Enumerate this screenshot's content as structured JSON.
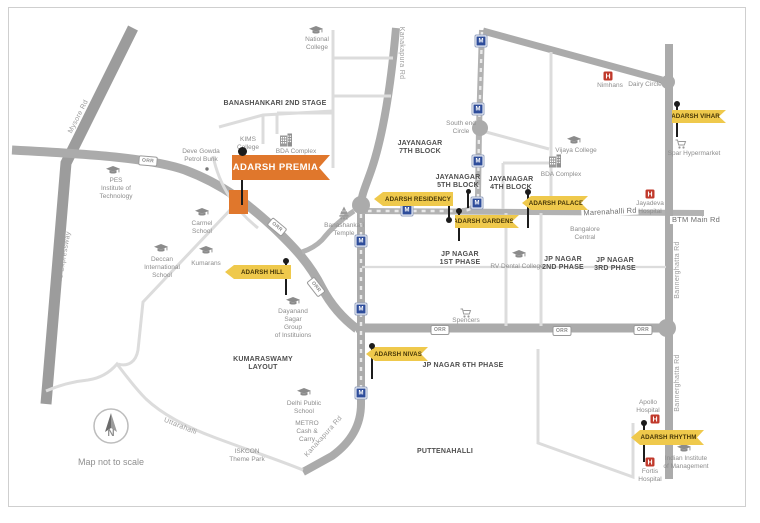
{
  "map": {
    "scale_note": "Map not to scale",
    "compass_label": "N",
    "metro_label": "M",
    "orr_label": "ORR",
    "colors": {
      "accent_orange": "#e0772c",
      "flag_yellow": "#efc94c",
      "flag_text": "#463607",
      "hospital_red": "#c0392b",
      "metro_blue": "#2e4d9b",
      "road_major": "#ababab",
      "road_minor": "#dcdcdc"
    },
    "premia": {
      "label": "ADARSH PREMIA",
      "x": 232,
      "y": 155,
      "w": 98,
      "h": 25,
      "site": {
        "x": 229,
        "y": 190,
        "w": 19,
        "h": 24
      },
      "pin": {
        "x": 242,
        "y1": 151,
        "y2": 205
      }
    },
    "property_flags": [
      {
        "id": "residency",
        "label": "ADARSH RESIDENCY",
        "x": 374,
        "y": 192,
        "w": 79,
        "h": 14,
        "shape": "arrow-straight",
        "pin": {
          "x": 449,
          "y1": 194,
          "y2": 220,
          "ball": "bottom"
        }
      },
      {
        "id": "gardens",
        "label": "ADARSH GARDENS",
        "x": 455,
        "y": 215,
        "w": 64,
        "h": 13,
        "shape": "flat-swallow",
        "pin": {
          "x": 459,
          "y1": 211,
          "y2": 241,
          "ball": "top"
        }
      },
      {
        "id": "palace",
        "label": "ADARSH PALACE",
        "x": 522,
        "y": 196,
        "w": 66,
        "h": 14,
        "shape": "arrow-swallow",
        "pin": {
          "x": 528,
          "y1": 192,
          "y2": 228,
          "ball": "top"
        }
      },
      {
        "id": "vihar",
        "label": "ADARSH VIHAR",
        "x": 672,
        "y": 110,
        "w": 54,
        "h": 13,
        "shape": "flat-swallow",
        "pin": {
          "x": 677,
          "y1": 104,
          "y2": 137,
          "ball": "top"
        }
      },
      {
        "id": "hill",
        "label": "ADARSH HILL",
        "x": 225,
        "y": 265,
        "w": 66,
        "h": 14,
        "shape": "arrow-straight",
        "pin": {
          "x": 286,
          "y1": 261,
          "y2": 295,
          "ball": "top"
        }
      },
      {
        "id": "nivas",
        "label": "ADARSH NIVAS",
        "x": 366,
        "y": 347,
        "w": 62,
        "h": 14,
        "shape": "arrow-swallow",
        "pin": {
          "x": 372,
          "y1": 346,
          "y2": 379,
          "ball": "top"
        }
      },
      {
        "id": "rhythm",
        "label": "ADARSH RHYTHM",
        "x": 631,
        "y": 430,
        "w": 73,
        "h": 15,
        "shape": "arrow-swallow",
        "pin": {
          "x": 644,
          "y1": 423,
          "y2": 462,
          "ball": "top"
        }
      }
    ],
    "extra_pins": [
      {
        "name": "jayanagar-5th-block-pin",
        "x": 468,
        "y1": 191,
        "y2": 208,
        "ball": "top"
      }
    ],
    "area_labels": [
      {
        "text": "BANASHANKARI 2ND STAGE",
        "x": 275,
        "y": 104
      },
      {
        "text": "JAYANAGAR\n7TH BLOCK",
        "x": 420,
        "y": 148
      },
      {
        "text": "JAYANAGAR\n5TH BLOCK",
        "x": 458,
        "y": 182
      },
      {
        "text": "JAYANAGAR\n4TH BLOCK",
        "x": 511,
        "y": 184
      },
      {
        "text": "JP NAGAR\n1ST PHASE",
        "x": 460,
        "y": 259
      },
      {
        "text": "JP NAGAR\n2ND PHASE",
        "x": 563,
        "y": 264
      },
      {
        "text": "JP NAGAR\n3RD PHASE",
        "x": 615,
        "y": 265
      },
      {
        "text": "JP NAGAR 6TH PHASE",
        "x": 463,
        "y": 366
      },
      {
        "text": "KUMARASWAMY\nLAYOUT",
        "x": 263,
        "y": 364
      },
      {
        "text": "PUTTENAHALLI",
        "x": 445,
        "y": 452
      }
    ],
    "poi_labels": [
      {
        "name": "national-college",
        "icon": "grad-cap",
        "ix": 316,
        "iy": 31,
        "text": "National\nCollege",
        "x": 317,
        "y": 44
      },
      {
        "name": "kims-college",
        "icon": null,
        "text": "KIMS\nCollege",
        "x": 248,
        "y": 144
      },
      {
        "name": "bda-complex-west",
        "icon": "building",
        "ix": 286,
        "iy": 140,
        "text": "BDA Complex",
        "x": 296,
        "y": 152
      },
      {
        "name": "deve-gowda-petrol-bunk",
        "icon": "dot",
        "ix": 207,
        "iy": 169,
        "text": "Deve Gowda\nPetrol Bunk",
        "x": 201,
        "y": 156
      },
      {
        "name": "pes-institute-of-technology",
        "icon": "grad-cap",
        "ix": 113,
        "iy": 171,
        "text": "PES\nInstitute of\nTechnology",
        "x": 116,
        "y": 189
      },
      {
        "name": "carmel-school",
        "icon": "grad-cap",
        "ix": 202,
        "iy": 213,
        "text": "Carmel\nSchool",
        "x": 202,
        "y": 228
      },
      {
        "name": "deccan-international-school",
        "icon": "grad-cap",
        "ix": 161,
        "iy": 249,
        "text": "Deccan\nInternational\nSchool",
        "x": 162,
        "y": 268
      },
      {
        "name": "kumarans",
        "icon": "grad-cap",
        "ix": 206,
        "iy": 251,
        "text": "Kumarans",
        "x": 206,
        "y": 264
      },
      {
        "name": "dayanand-sagar-group",
        "icon": "grad-cap",
        "ix": 293,
        "iy": 302,
        "text": "Dayanand\nSagar\nGroup\nof Instituions",
        "x": 293,
        "y": 324
      },
      {
        "name": "banashankari-temple",
        "icon": "temple",
        "ix": 344,
        "iy": 213,
        "text": "Banashankari\nTemple",
        "x": 344,
        "y": 230
      },
      {
        "name": "spencers",
        "icon": "cart",
        "ix": 466,
        "iy": 313,
        "text": "Spencers",
        "x": 466,
        "y": 321
      },
      {
        "name": "rv-dental-college",
        "icon": "grad-cap",
        "ix": 519,
        "iy": 255,
        "text": "RV Dental College",
        "x": 517,
        "y": 267
      },
      {
        "name": "vijaya-college",
        "icon": "grad-cap",
        "ix": 574,
        "iy": 141,
        "text": "Vijaya College",
        "x": 576,
        "y": 151
      },
      {
        "name": "bda-complex-east",
        "icon": "building",
        "ix": 555,
        "iy": 161,
        "text": "BDA Complex",
        "x": 561,
        "y": 175
      },
      {
        "name": "nimhans",
        "icon": "hospital",
        "ix": 608,
        "iy": 76,
        "text": "Nimhans",
        "x": 610,
        "y": 86
      },
      {
        "name": "dairy-circle",
        "icon": null,
        "text": "Dairy Circle",
        "x": 645,
        "y": 85
      },
      {
        "name": "spar-hypermarket",
        "icon": "cart",
        "ix": 681,
        "iy": 144,
        "text": "Spar Hypermarket",
        "x": 694,
        "y": 154
      },
      {
        "name": "jayadeva-hospital",
        "icon": "hospital",
        "ix": 650,
        "iy": 194,
        "text": "Jayadeva\nHospital",
        "x": 650,
        "y": 208
      },
      {
        "name": "south-end-circle",
        "icon": null,
        "text": "South end\nCircle",
        "x": 461,
        "y": 128
      },
      {
        "name": "bangalore-central",
        "icon": null,
        "text": "Bangalore\nCentral",
        "x": 585,
        "y": 234
      },
      {
        "name": "delhi-public-school",
        "icon": "grad-cap",
        "ix": 304,
        "iy": 393,
        "text": "Delhi Public\nSchool",
        "x": 304,
        "y": 408
      },
      {
        "name": "metro-cash-and-carry",
        "icon": null,
        "text": "METRO\nCash &\nCarry",
        "x": 307,
        "y": 432
      },
      {
        "name": "iskcon-theme-park",
        "icon": null,
        "text": "ISKCON\nTheme Park",
        "x": 247,
        "y": 456
      },
      {
        "name": "apollo-hospital",
        "icon": "hospital",
        "ix": 655,
        "iy": 419,
        "text": "Apollo\nHospital",
        "x": 648,
        "y": 407
      },
      {
        "name": "fortis-hospital",
        "icon": "hospital",
        "ix": 650,
        "iy": 462,
        "text": "Fortis\nHospital",
        "x": 650,
        "y": 476
      },
      {
        "name": "indian-institute-of-management",
        "icon": "grad-cap",
        "ix": 684,
        "iy": 449,
        "text": "Indian Institute\nof Management",
        "x": 686,
        "y": 463
      }
    ],
    "road_labels": [
      {
        "text": "Mysore Rd",
        "x": 79,
        "y": 117,
        "rot": -63,
        "dark": false
      },
      {
        "text": "BMIC Expressway",
        "x": 64,
        "y": 262,
        "rot": -80,
        "dark": false
      },
      {
        "text": "Kanakapura Rd",
        "x": 401,
        "y": 53,
        "rot": 90,
        "dark": false
      },
      {
        "text": "Kanakapura Rd",
        "x": 324,
        "y": 437,
        "rot": -48,
        "dark": false
      },
      {
        "text": "Uttarahalli",
        "x": 180,
        "y": 427,
        "rot": 22,
        "dark": false
      },
      {
        "text": "Bannerghatta Rd",
        "x": 678,
        "y": 270,
        "rot": -90,
        "dark": false
      },
      {
        "text": "Bannerghatta Rd",
        "x": 678,
        "y": 383,
        "rot": -90,
        "dark": false
      },
      {
        "text": "Marenahalli Rd",
        "x": 610,
        "y": 212,
        "rot": -3,
        "dark": true
      },
      {
        "text": "BTM Main Rd",
        "x": 696,
        "y": 220,
        "rot": 0,
        "dark": true
      }
    ],
    "orr_badges": [
      {
        "x": 148,
        "y": 161,
        "rot": 5
      },
      {
        "x": 277,
        "y": 227,
        "rot": 40
      },
      {
        "x": 316,
        "y": 287,
        "rot": 52
      },
      {
        "x": 440,
        "y": 330,
        "rot": 0
      },
      {
        "x": 562,
        "y": 331,
        "rot": 0
      },
      {
        "x": 643,
        "y": 330,
        "rot": 0
      }
    ],
    "metro_stations": [
      {
        "x": 481,
        "y": 41
      },
      {
        "x": 478,
        "y": 109
      },
      {
        "x": 478,
        "y": 161
      },
      {
        "x": 477,
        "y": 203
      },
      {
        "x": 407,
        "y": 210
      },
      {
        "x": 361,
        "y": 241
      },
      {
        "x": 361,
        "y": 309
      },
      {
        "x": 361,
        "y": 393
      }
    ]
  }
}
